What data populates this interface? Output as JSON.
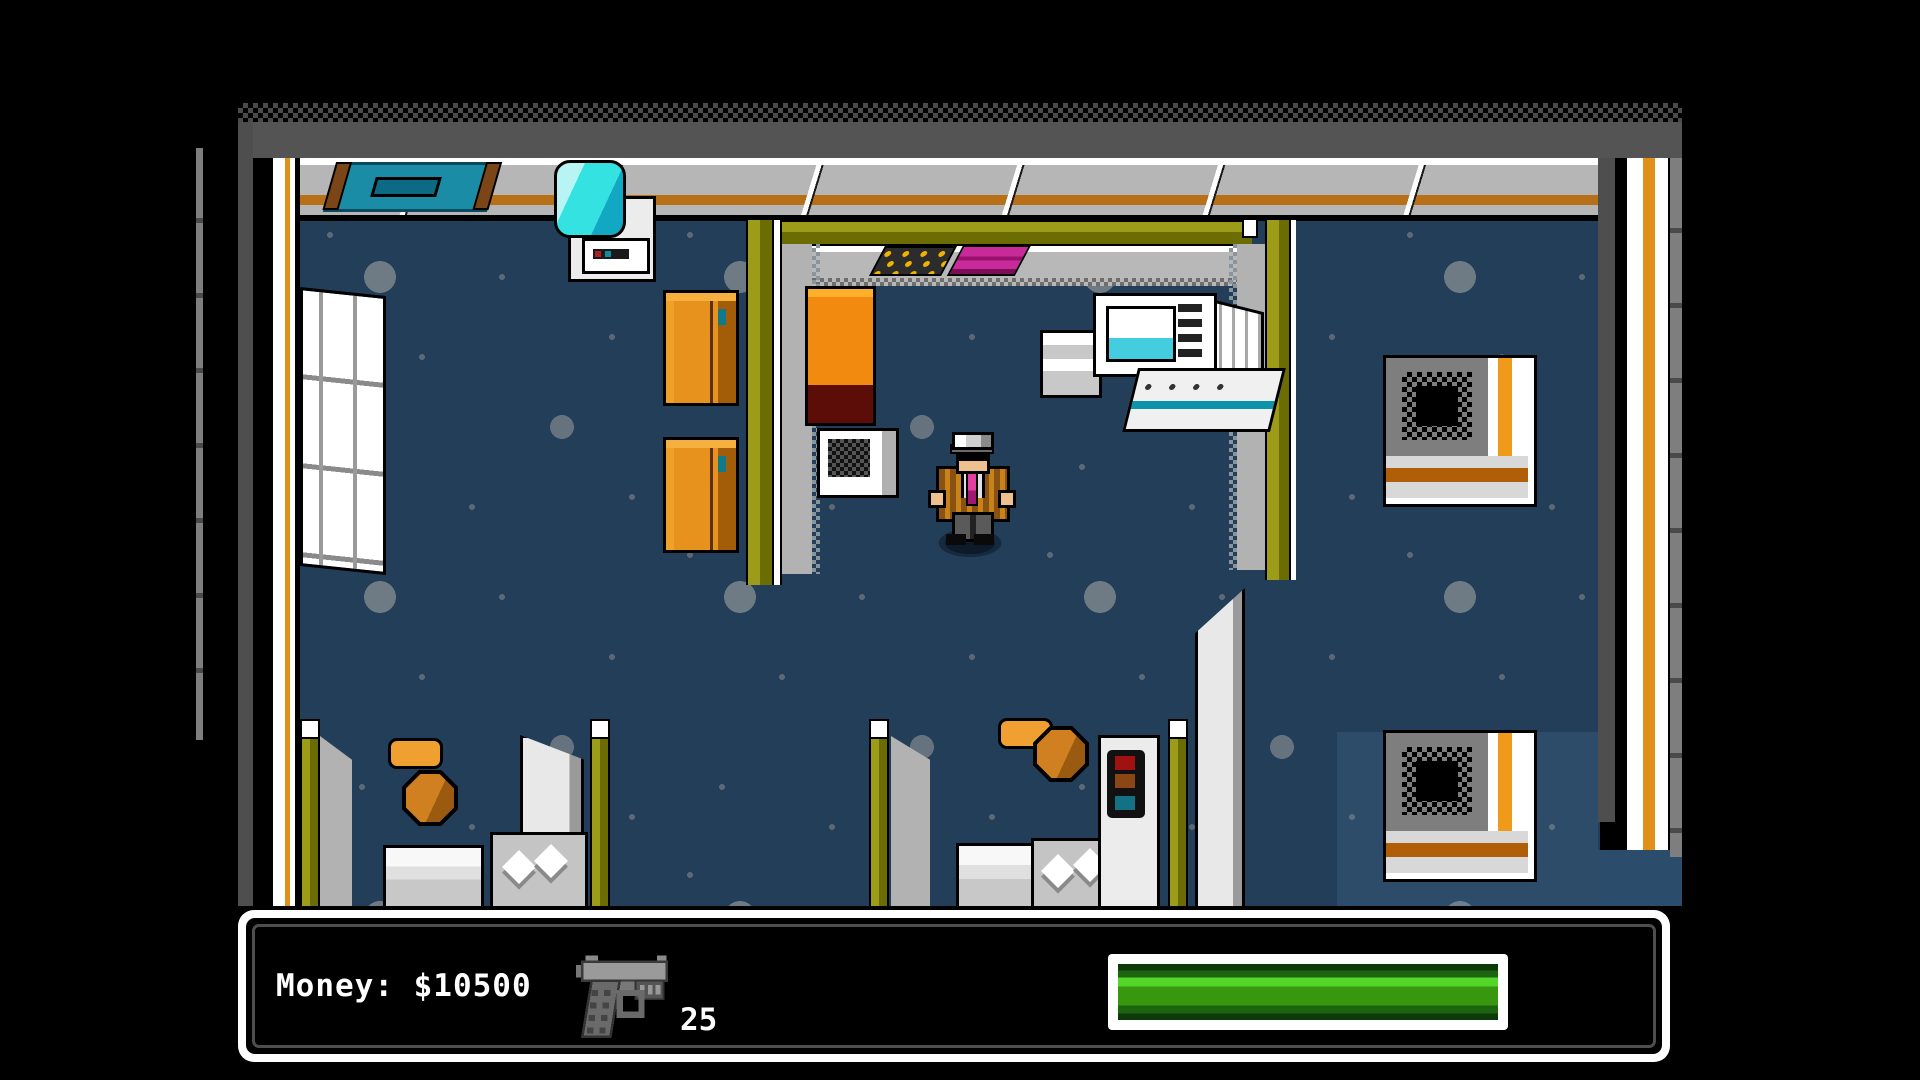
{
  "meta": {
    "app_type": "retro-pixel-game",
    "screen": "gameplay-office-interior"
  },
  "hud": {
    "money_text": "Money: $10500",
    "weapon_icon": "pistol-icon",
    "ammo_count": "25",
    "health": {
      "percent_full": 100,
      "fill_color": "#38970f",
      "highlight_color": "#52d62a",
      "shadow_color": "#0c3a08",
      "frame_color": "#ffffff"
    }
  },
  "palette": {
    "background": "#000000",
    "carpet": "#223e59",
    "carpet_light_patch": "#2b4c6b",
    "carpet_dots": "#6e7a84",
    "wall_face": "#b6b6b6",
    "wall_stripe_orange": "#b87018",
    "partition_olive": "#9c9c18",
    "partition_olive_dark": "#6c6c04",
    "cabinet_orange": "#e8921e",
    "table_orange": "#f28a10",
    "table_maroon": "#5c0d08",
    "chair_orange": "#d08020",
    "painting_teal": "#1a8ca6",
    "cooler_cyan": "#35e2e2",
    "monitor_screen_cyan": "#44ccdf",
    "binder_magenta": "#c82a9a",
    "mat_dots_yellow": "#f0b400",
    "hud_border": "#ffffff",
    "hud_inner_line": "#4e4e4e"
  },
  "scene_objects": [
    "wall-painting",
    "water-cooler",
    "wall-shelf",
    "filing-cabinet-1",
    "filing-cabinet-2",
    "conference-room",
    "reception-counter",
    "keyboard-mat",
    "magenta-binder",
    "orange-side-table",
    "printer-box",
    "computer-workstation",
    "player-character",
    "ac-unit-1",
    "ac-unit-2",
    "cubicle-left",
    "cubicle-middle",
    "office-chair-1",
    "office-chair-2",
    "office-desk-1",
    "office-desk-2",
    "office-desk-3",
    "copier-machine",
    "paper-diamonds"
  ]
}
